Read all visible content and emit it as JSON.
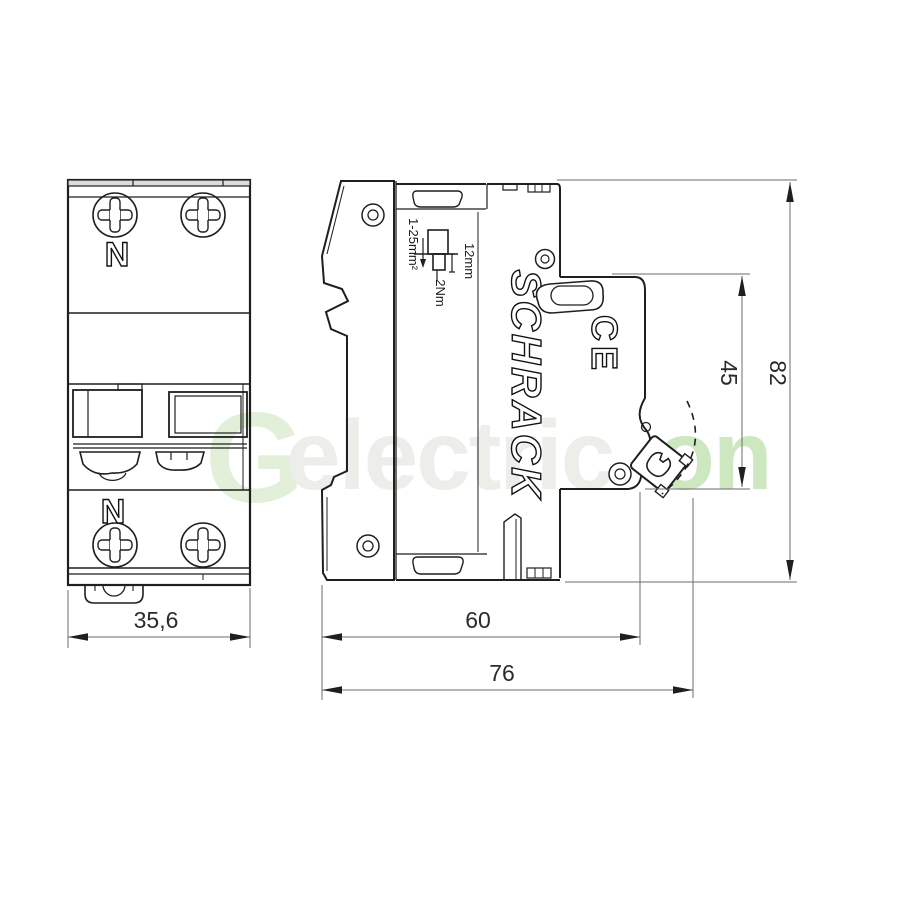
{
  "diagram": {
    "title": "Circuit breaker dimension drawing",
    "watermark": {
      "mark": "G",
      "text": "electric",
      "suffix": "on",
      "gray_color": "#edeeea",
      "green_color": "#cde7c0",
      "mark_color": "#e2efd9"
    },
    "front_view": {
      "neutral_top": "N",
      "neutral_bottom": "N",
      "width_dim": "35,6"
    },
    "side_view": {
      "brand": "SCHRACK",
      "ce_mark": "CE",
      "terminal": {
        "wire_range": "1-25mm²",
        "strip_length": "12mm",
        "torque": "2Nm"
      },
      "dims": {
        "overall_height": "82",
        "front_height": "45",
        "depth": "60",
        "overall_depth": "76"
      }
    },
    "colors": {
      "line": "#1f1f1f",
      "dim_line": "#6e6e6e",
      "dim_text": "#2b2b2b"
    }
  }
}
